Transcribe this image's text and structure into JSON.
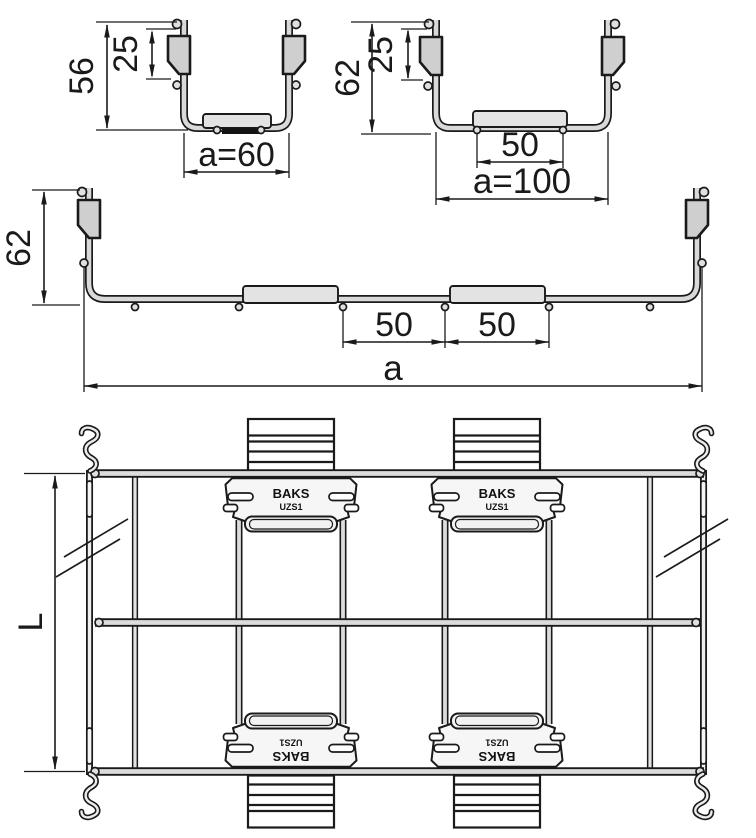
{
  "cross_section_small": {
    "height": "56",
    "clip_height": "25",
    "width": "a=60"
  },
  "cross_section_medium": {
    "height": "62",
    "clip_height": "25",
    "rung_width": "50",
    "width": "a=100"
  },
  "cross_section_large": {
    "height": "62",
    "rung_pitch_1": "50",
    "rung_pitch_2": "50",
    "width": "a"
  },
  "plan_view": {
    "length": "L",
    "connector": {
      "brand": "BAKS",
      "model": "UZS1"
    }
  },
  "colors": {
    "outline": "#1a1a1a",
    "wire_fill": "#d9d9d9",
    "rung_fill": "#e3e3e3",
    "clip_fill": "#cfcfcf",
    "background": "#ffffff"
  }
}
